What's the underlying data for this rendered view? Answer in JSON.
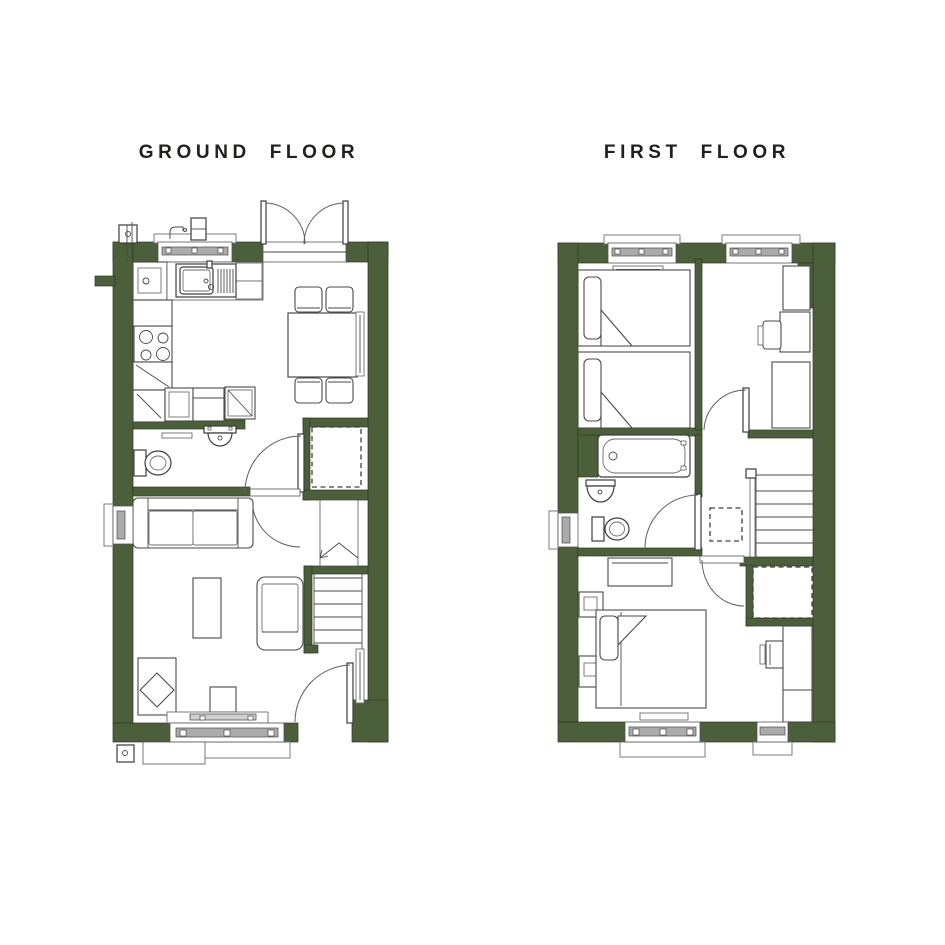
{
  "titles": {
    "ground_floor": "GROUND FLOOR",
    "first_floor": "FIRST FLOOR"
  },
  "colors": {
    "wall_green": "#4a5f3a",
    "ink": "#20201e",
    "line_dark": "#4a4a4a",
    "fixture_gray": "#ababab",
    "background": "#ffffff"
  },
  "symbols": {
    "ground_floor": [
      "french-doors",
      "kitchen-window",
      "outside-tap",
      "meter-box",
      "boiler",
      "kitchen-sink",
      "kitchen-hob",
      "kitchen-units",
      "dining-table",
      "dining-chairs",
      "radiator",
      "wc-toilet",
      "wc-basin",
      "wc-door",
      "storage-cupboard",
      "hall-door",
      "sofa",
      "coffee-table",
      "armchair",
      "chaise",
      "tv-unit",
      "staircase-up-arrow",
      "front-door",
      "bottom-window",
      "side-window"
    ],
    "first_floor": [
      "twin-bed",
      "twin-bed",
      "radiator",
      "wardrobe",
      "desk-chair",
      "bath",
      "basin",
      "toilet",
      "bathroom-door",
      "bedroom-door",
      "loft-hatch",
      "staircase",
      "stair-bulkhead-cupboard",
      "double-bed",
      "bedside-table",
      "dresser",
      "wardrobe",
      "top-windows",
      "bottom-windows",
      "side-window"
    ]
  }
}
